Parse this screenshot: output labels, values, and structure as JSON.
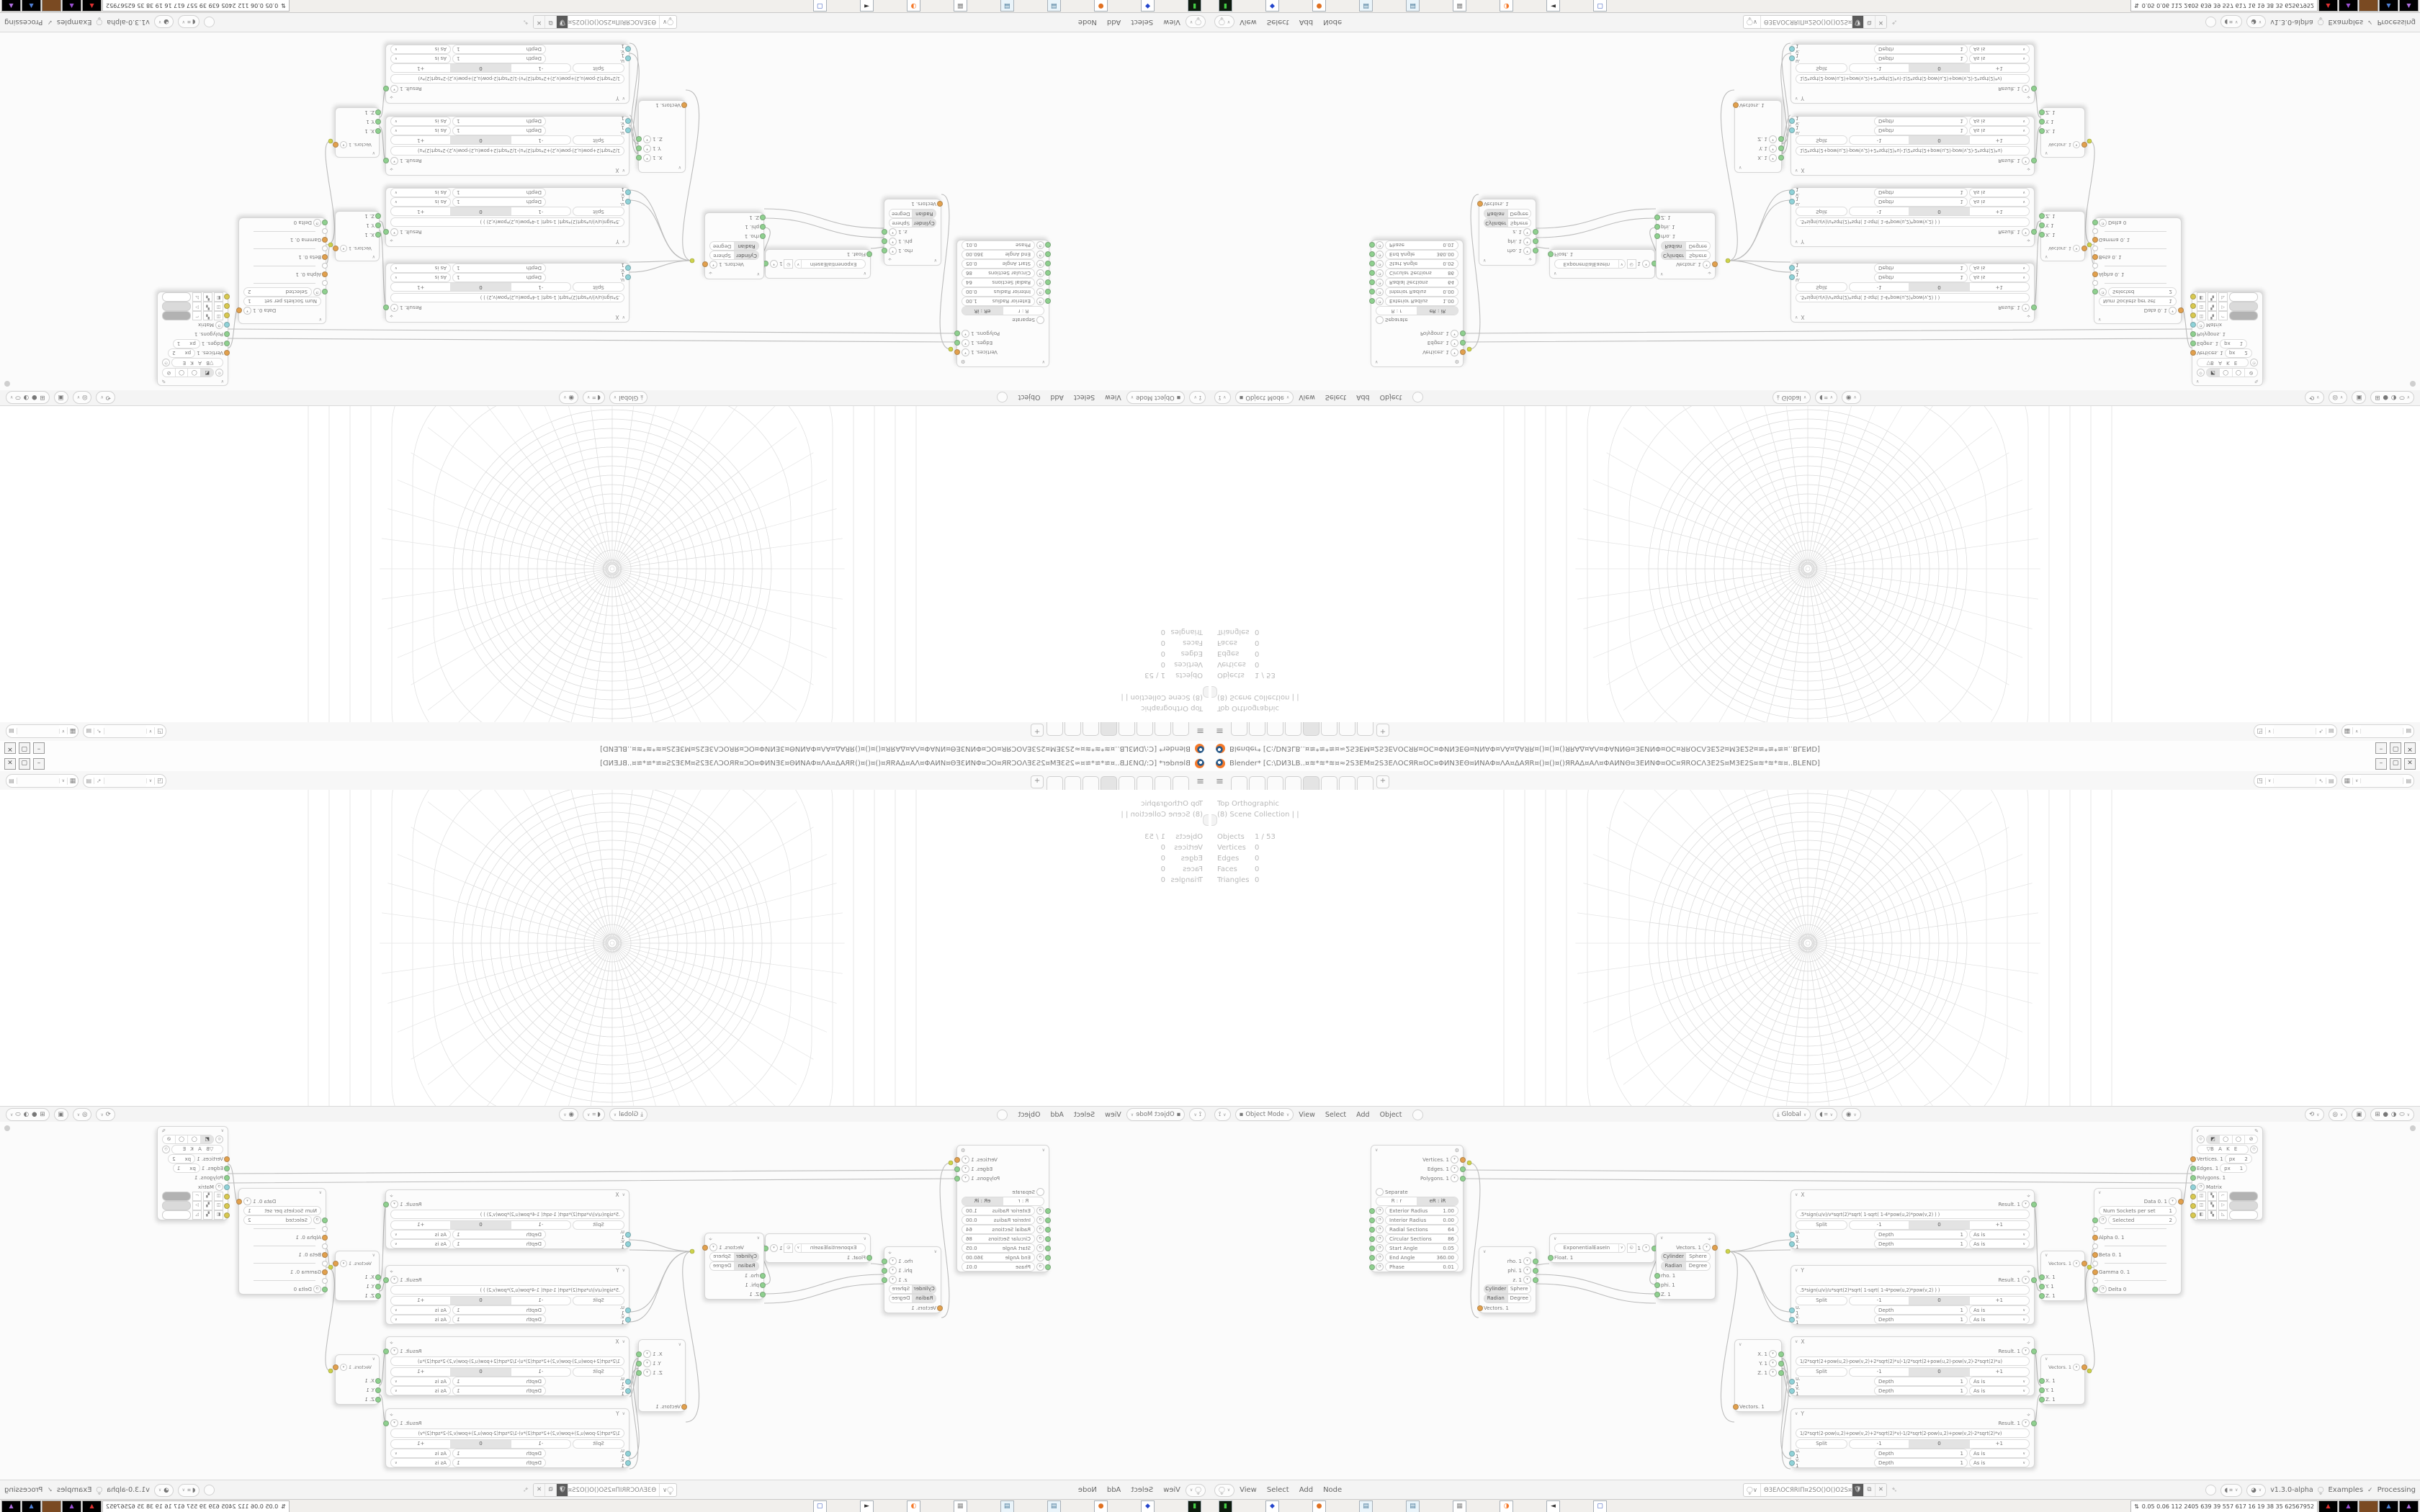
{
  "window": {
    "title": "Blender*  [C:\\DИ3LB..¤≋*≋*≋¤≈2S3EM¤2S3EΛΟCЯR¤ΟC¤ΦИN3EΘ¤ИNAΦ¤ΛA¤ΔAЯR¤()¤()¤()ЯRAΔ¤AΛ¤ΦAИNΘ¤3EИNΦ¤ΟC¤ЯRΟCΛ3E2S¤M3E2S¤≋*≋*≋¤..BLEND]",
    "minimize": "–",
    "maximize": "▢",
    "close": "✕"
  },
  "topbar": {
    "tabs": [
      "",
      "",
      "",
      "",
      "",
      "",
      "",
      ""
    ],
    "active_tab_index": 4,
    "add_tab": "+",
    "scene_widget": {
      "value": ""
    },
    "layer_widget": {
      "value": ""
    }
  },
  "viewport": {
    "view_label": "Top Orthographic",
    "collection_label": "(8) Scene Collection | |",
    "stats": [
      {
        "label": "Objects",
        "value": "1 / 53"
      },
      {
        "label": "Vertices",
        "value": "0"
      },
      {
        "label": "Edges",
        "value": "0"
      },
      {
        "label": "Faces",
        "value": "0"
      },
      {
        "label": "Triangles",
        "value": "0"
      }
    ],
    "header": {
      "mode": "Object Mode",
      "menus": [
        "View",
        "Select",
        "Add",
        "Object"
      ],
      "orientation": "Global"
    }
  },
  "node_editor": {
    "header": {
      "menus": [
        "View",
        "Select",
        "Add",
        "Node"
      ],
      "tree_name": "Θ3EΛΟCЯRIΠ¤2SO()O()O2S¤ΠЯPOCΛ3EΘ",
      "version": "v1.3.0-alpha",
      "examples_label": "Examples",
      "processing_label": "Processing"
    },
    "nodes": {
      "generator": {
        "outputs": [
          "Vertices. 1",
          "Edges. 1",
          "Polygons. 1"
        ],
        "separate_label": "Separate",
        "mode_buttons": [
          "R : r",
          "eR : iR"
        ],
        "fields": [
          {
            "label": "Exterior Radius",
            "value": "1.00"
          },
          {
            "label": "Interior Radius",
            "value": "0.00"
          },
          {
            "label": "Radial Sections",
            "value": "64"
          },
          {
            "label": "Circular Sections",
            "value": "86"
          },
          {
            "label": "Start Angle",
            "value": "0.05"
          },
          {
            "label": "End Angle",
            "value": "360.00"
          },
          {
            "label": "Phase",
            "value": "0.01"
          }
        ]
      },
      "polar_output": {
        "outputs": [
          "rho. 1",
          "phi. 1",
          "z. 1"
        ],
        "btn_row1": [
          "Cylinder",
          "Sphere"
        ],
        "btn_row2": [
          "Radian",
          "Degree"
        ],
        "input": "Vectors. 1"
      },
      "easing": {
        "type": "ExponentialEaseIn",
        "value": "1",
        "input": "Float. 1"
      },
      "polar_input": {
        "output": "Vectors. 1",
        "btn_row1": [
          "Cylinder",
          "Sphere"
        ],
        "btn_row2": [
          "Radian",
          "Degree"
        ],
        "inputs": [
          "rho. 1",
          "phi. 1",
          "Z. 1"
        ]
      },
      "vector_decompose": {
        "outputs": [
          "X. 1",
          "Y. 1",
          "Z. 1"
        ],
        "input": "Vectors. 1"
      },
      "formula_common": {
        "result": "Result. 1",
        "split": "Split",
        "minus": "-1",
        "zero": "0",
        "plus": "+1",
        "depth_label": "Depth",
        "depth_value": "1",
        "wrap_mode": "As is",
        "input_u": "u. 1",
        "input_v": "v. 1"
      },
      "formulas": [
        {
          "title": "X",
          "formula": ".5*sign(u/v)/v*sqrt(2)*sqrt(   1-sqrt(   1-4*pow(u,2)*pow(v,2)      )      )"
        },
        {
          "title": "Y",
          "formula": ".5*sign(u/v)/u*sqrt(2)*sqrt(   1-sqrt(   1-4*pow(u,2)*pow(v,2)      )      )"
        },
        {
          "title": "X",
          "formula": "1/2*sqrt(2+pow(u,2)-pow(v,2)+2*sqrt(2)*u)-1/2*sqrt(2+pow(u,2)-pow(v,2)-2*sqrt(2)*u)"
        },
        {
          "title": "Y",
          "formula": "1/2*sqrt(2-pow(u,2)+pow(v,2)+2*sqrt(2)*v)-1/2*sqrt(2-pow(u,2)+pow(v,2)-2*sqrt(2)*v)"
        }
      ],
      "vector_in_1": {
        "output": "Vectors. 1",
        "inputs": [
          "X. 1",
          "Y. 1",
          "Z. 1"
        ]
      },
      "vector_in_2": {
        "output": "Vectors. 1",
        "inputs": [
          "X. 1",
          "Y. 1",
          "Z. 1"
        ]
      },
      "switcher": {
        "output": "Data 0. 1",
        "field1": {
          "label": "Num Sockets per set",
          "value": "1"
        },
        "field2": {
          "label": "Selected",
          "value": "2"
        },
        "inputs": [
          "Alpha 0. 1",
          "Beta 0. 1",
          "Gamma 0. 1",
          "Delta 0"
        ]
      },
      "viewer": {
        "bake_label": "B A K E",
        "rows": [
          {
            "label": "Vertices. 1",
            "unit": "px",
            "value": "2"
          },
          {
            "label": "Edges. 1",
            "unit": "px",
            "value": "1"
          },
          {
            "label": "Polygons. 1",
            "unit": "",
            "value": ""
          },
          {
            "label": "Matrix",
            "unit": "",
            "value": ""
          }
        ],
        "swatches": [
          "#b2b2b2",
          "#dadada",
          "#ffffff"
        ]
      }
    }
  },
  "taskbar": {
    "icons": [
      "terminal-icon",
      "floppy-64-icon",
      "firefox-icon",
      "notepad-icon",
      "notepad-icon",
      "image-viewer-icon",
      "blender-icon",
      "speaker-icon",
      "window-icon"
    ],
    "tray": {
      "stats": "0.05 0.06 112 2405 639  39  557 617  16  19  38  35 62567952",
      "graphs": [
        "red",
        "purple",
        "brown",
        "blue",
        "violet"
      ]
    }
  },
  "colors": {
    "socket_green": "#8ed08e",
    "socket_orange": "#e2a04c",
    "socket_cyan": "#8fd2d8",
    "socket_yellow": "#d8c84e",
    "wire": "#bcbcbc",
    "blender_orange": "#f5792a"
  }
}
